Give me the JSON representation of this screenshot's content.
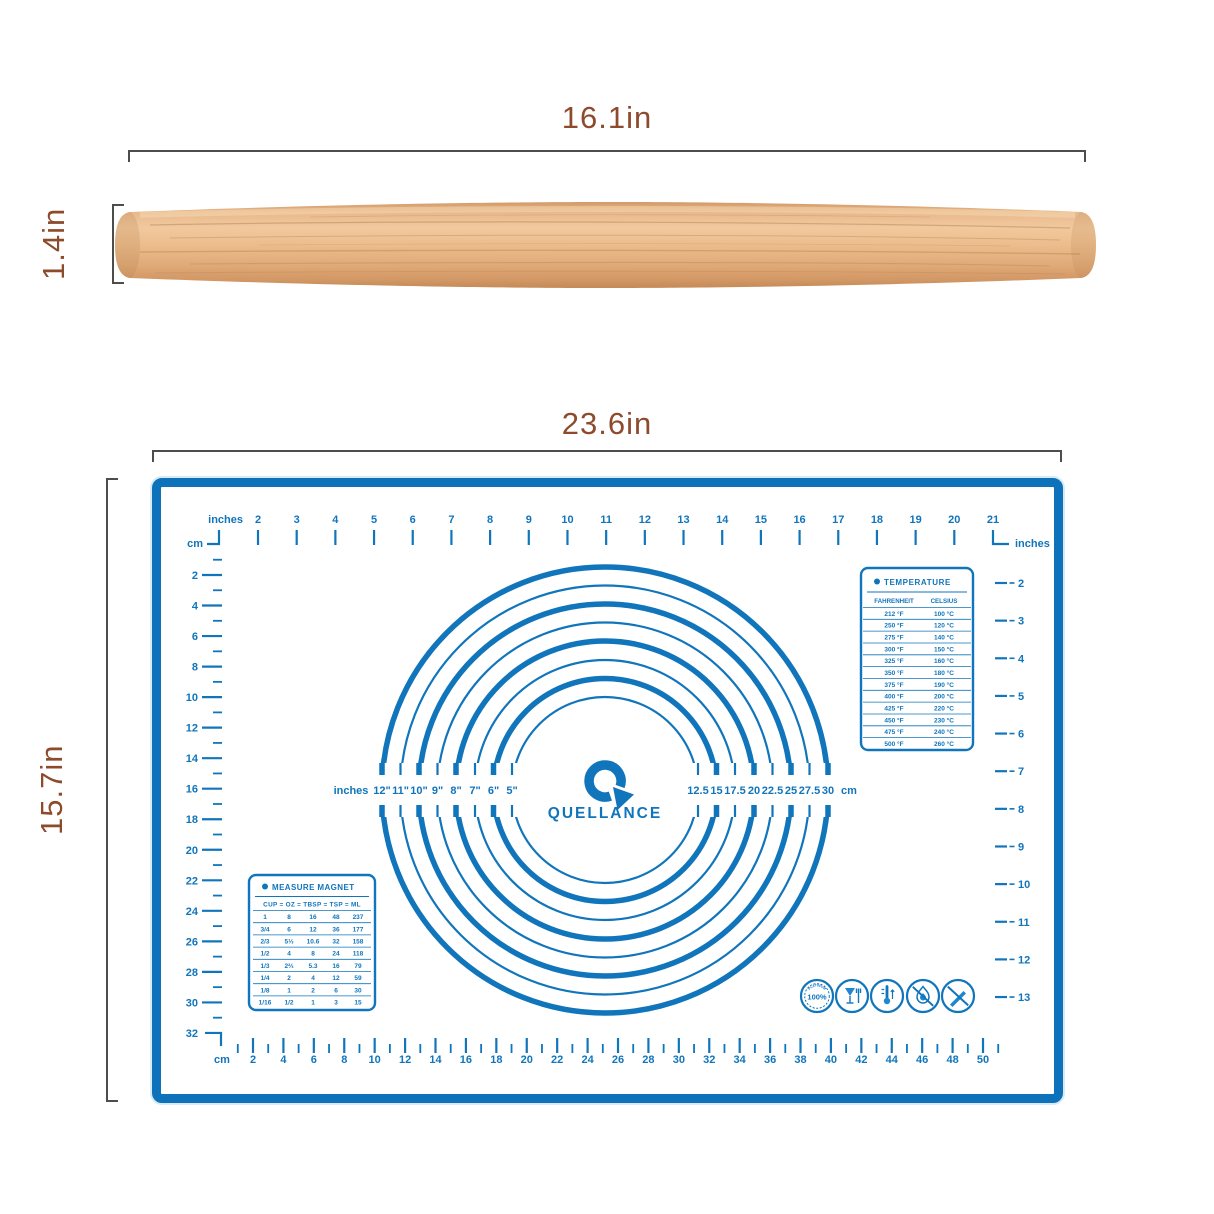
{
  "product": {
    "rolling_pin": {
      "length": "16.1in",
      "diameter": "1.4in"
    },
    "mat": {
      "width": "23.6in",
      "height": "15.7in"
    }
  },
  "mat": {
    "brand": "QUELLANCE",
    "rulers": {
      "top": {
        "unit_label": "inches",
        "corner_unit_left": "cm",
        "corner_unit_right": "inches",
        "numbers": [
          2,
          3,
          4,
          5,
          6,
          7,
          8,
          9,
          10,
          11,
          12,
          13,
          14,
          15,
          16,
          17,
          18,
          19,
          20,
          21
        ]
      },
      "left": {
        "numbers": [
          2,
          4,
          6,
          8,
          10,
          12,
          14,
          16,
          18,
          20,
          22,
          24,
          26,
          28,
          30,
          32
        ]
      },
      "right": {
        "numbers": [
          2,
          3,
          4,
          5,
          6,
          7,
          8,
          9,
          10,
          11,
          12,
          13
        ]
      },
      "bottom": {
        "unit_label": "cm",
        "numbers": [
          2,
          4,
          6,
          8,
          10,
          12,
          14,
          16,
          18,
          20,
          22,
          24,
          26,
          28,
          30,
          32,
          34,
          36,
          38,
          40,
          42,
          44,
          46,
          48,
          50
        ]
      }
    },
    "circles": {
      "left_unit_label": "inches",
      "right_unit_label": "cm",
      "inch_labels": [
        "12\"",
        "11\"",
        "10\"",
        "9\"",
        "8\"",
        "7\"",
        "6\"",
        "5\""
      ],
      "cm_labels": [
        "12.5",
        "15",
        "17.5",
        "20",
        "22.5",
        "25",
        "27.5",
        "30"
      ]
    },
    "temperature_table": {
      "title": "TEMPERATURE",
      "columns": [
        "FAHRENHEIT",
        "CELSIUS"
      ],
      "rows": [
        [
          "212 °F",
          "100 °C"
        ],
        [
          "250 °F",
          "120 °C"
        ],
        [
          "275 °F",
          "140 °C"
        ],
        [
          "300 °F",
          "150 °C"
        ],
        [
          "325 °F",
          "160 °C"
        ],
        [
          "350 °F",
          "180 °C"
        ],
        [
          "375 °F",
          "190 °C"
        ],
        [
          "400 °F",
          "200 °C"
        ],
        [
          "425 °F",
          "220 °C"
        ],
        [
          "450 °F",
          "230 °C"
        ],
        [
          "475 °F",
          "240 °C"
        ],
        [
          "500 °F",
          "260 °C"
        ]
      ]
    },
    "measure_table": {
      "title": "MEASURE MAGNET",
      "header": "CUP = OZ = TBSP = TSP = ML",
      "rows": [
        [
          "1",
          "8",
          "16",
          "48",
          "237"
        ],
        [
          "3/4",
          "6",
          "12",
          "36",
          "177"
        ],
        [
          "2/3",
          "5⅓",
          "10.6",
          "32",
          "158"
        ],
        [
          "1/2",
          "4",
          "8",
          "24",
          "118"
        ],
        [
          "1/3",
          "2⅔",
          "5.3",
          "16",
          "79"
        ],
        [
          "1/4",
          "2",
          "4",
          "12",
          "59"
        ],
        [
          "1/8",
          "1",
          "2",
          "6",
          "30"
        ],
        [
          "1/16",
          "1/2",
          "1",
          "3",
          "15"
        ]
      ]
    },
    "badges": {
      "platinum_label": "PLATINUM",
      "platinum_value": "100%"
    }
  },
  "colors": {
    "mat_blue": "#1175bb",
    "dimension_brown": "#8d4b2c"
  }
}
